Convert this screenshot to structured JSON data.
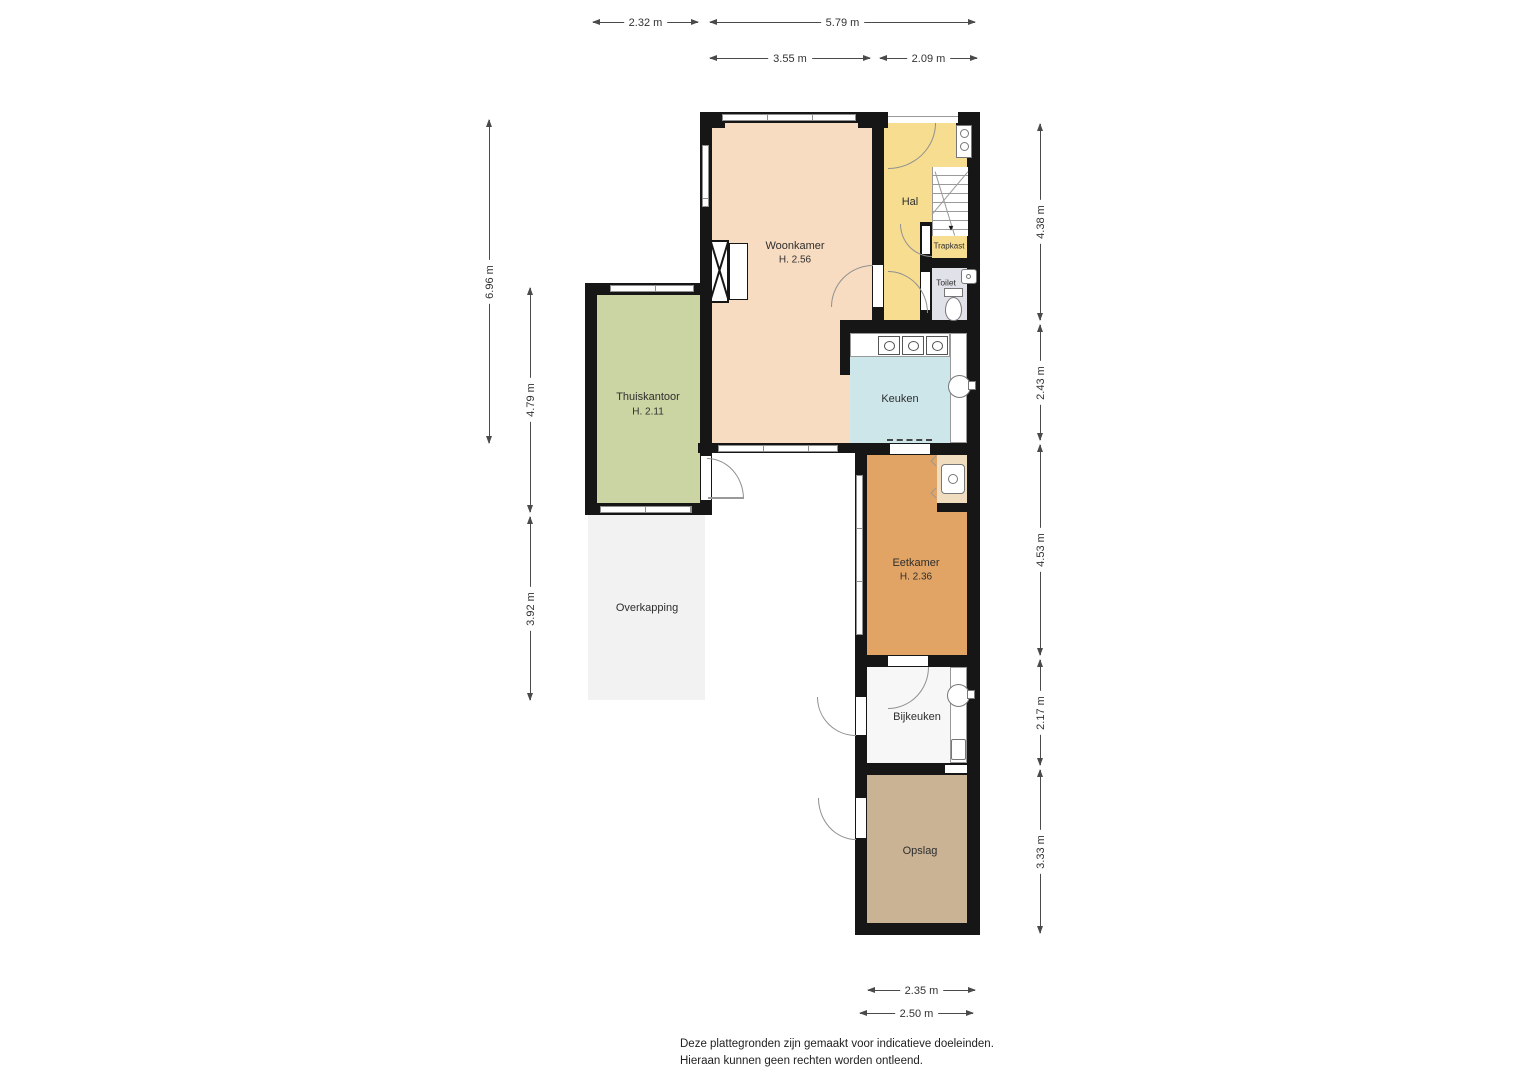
{
  "rooms": [
    {
      "id": "woonkamer",
      "label": "Woonkamer",
      "height_label": "H. 2.56",
      "color": "#f8dcc1"
    },
    {
      "id": "hal",
      "label": "Hal",
      "color": "#f6dd8f"
    },
    {
      "id": "trapkast",
      "label": "Trapkast",
      "color": "#f6dd8f"
    },
    {
      "id": "toilet",
      "label": "Toilet",
      "color": "#e0e1e9"
    },
    {
      "id": "keuken",
      "label": "Keuken",
      "color": "#cde6ea"
    },
    {
      "id": "thuiskantoor",
      "label": "Thuiskantoor",
      "height_label": "H. 2.11",
      "color": "#cbd5a3"
    },
    {
      "id": "overkapping",
      "label": "Overkapping",
      "color": "#f2f2f2"
    },
    {
      "id": "eetkamer",
      "label": "Eetkamer",
      "height_label": "H. 2.36",
      "color": "#e1a465"
    },
    {
      "id": "bijkeuken",
      "label": "Bijkeuken",
      "color": "#f7f7f7"
    },
    {
      "id": "opslag",
      "label": "Opslag",
      "color": "#c9b394"
    }
  ],
  "dimensions": {
    "top": [
      {
        "label": "2.32 m"
      },
      {
        "label": "5.79 m"
      },
      {
        "label": "3.55 m"
      },
      {
        "label": "2.09 m"
      }
    ],
    "left": [
      {
        "label": "6.96 m"
      },
      {
        "label": "4.79 m"
      },
      {
        "label": "3.92 m"
      }
    ],
    "right": [
      {
        "label": "4.38 m"
      },
      {
        "label": "2.43 m"
      },
      {
        "label": "4.53 m"
      },
      {
        "label": "2.17 m"
      },
      {
        "label": "3.33 m"
      }
    ],
    "bottom": [
      {
        "label": "2.35 m"
      },
      {
        "label": "2.50 m"
      }
    ]
  },
  "glyphs": {
    "stairs_down_arrow": "▼"
  },
  "footer": {
    "line1": "Deze plattegronden zijn gemaakt voor indicatieve doeleinden.",
    "line2": "Hieraan kunnen geen rechten worden ontleend."
  },
  "palette": {
    "wall": "#161616",
    "dimension_line": "#4a4a4a",
    "fixture_outline": "#777777"
  }
}
